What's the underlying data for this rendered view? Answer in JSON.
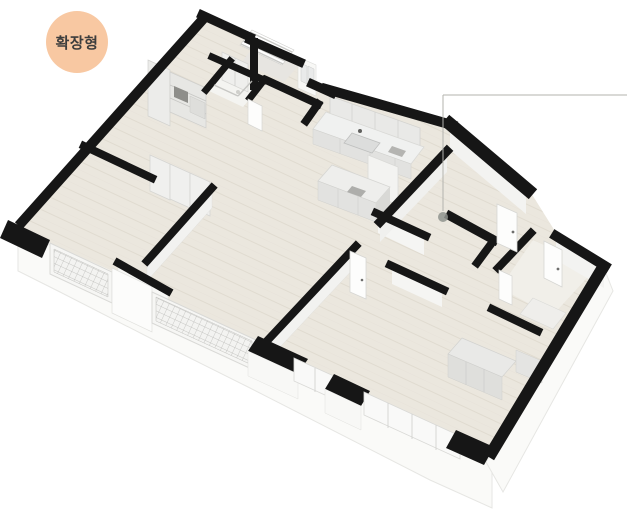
{
  "badge": {
    "label": "확장형",
    "bg": "#f8c8a2",
    "text_color": "#3d3d3d"
  },
  "palette": {
    "wall_black": "#161616",
    "floor_wood": "#ebe7de",
    "plank_line": "#e0dbd0",
    "frame_gray": "#d9d9d6",
    "callout_line": "#b3b3ae",
    "callout_dot": "#8f938e"
  },
  "floorplan": {
    "description": "3D isometric apartment floor plan, extended (확장형) layout",
    "shapes": [
      {
        "n": "exterior-wall-skirt-left",
        "t": "pg",
        "p": "18,228 52,246 112,274 152,293 258,342 298,360 336,380 366,396 458,439 492,456 492,508 430,480 250,388 150,338 60,292 18,271",
        "f": "#fafaf8",
        "s": "#e6e6e3",
        "w": 1
      },
      {
        "n": "exterior-wall-skirt-right",
        "t": "pg",
        "p": "604,268 613,291 503,492 486,462",
        "f": "#fafaf8",
        "s": "#e6e6e3",
        "w": 1
      },
      {
        "n": "left-wall-inner-face",
        "t": "pg",
        "p": "204,20 22,224 36,232 218,28",
        "f": "#ececea"
      },
      {
        "n": "floor-main",
        "t": "pg",
        "p": "206,14 300,58 314,84 332,92 450,124 528,190 533,196 558,236 604,266 492,452 458,436 364,393 334,380 294,360 256,341 150,293 112,271 52,244 16,226",
        "f": "url(#plank)"
      },
      {
        "n": "entry-floor",
        "t": "pg",
        "p": "254,46 298,66 284,82 242,62",
        "f": "#e7e5e1"
      },
      {
        "n": "bath1-floor",
        "t": "pg",
        "p": "230,62 266,79 243,107 207,90",
        "f": "#f4f4f1"
      },
      {
        "n": "bath2-floor",
        "t": "pg",
        "p": "533,240 596,268 552,316 500,288",
        "f": "#f1efe9"
      },
      {
        "n": "entry-stairs",
        "t": "pg",
        "p": "252,30 294,50 282,65 240,45",
        "f": "#ffffff",
        "s": "#cdcdca",
        "w": 0.6
      },
      {
        "n": "stair-step-1",
        "t": "l",
        "p": "250,32 292,52",
        "s": "#c8c8c5",
        "w": 1.4
      },
      {
        "n": "stair-step-2",
        "t": "l",
        "p": "248,35 290,55",
        "s": "#c8c8c5",
        "w": 1.4
      },
      {
        "n": "stair-step-3",
        "t": "l",
        "p": "246,37 288,57",
        "s": "#c8c8c5",
        "w": 1.4
      },
      {
        "n": "stair-step-4",
        "t": "l",
        "p": "245,39 287,59",
        "s": "#c8c8c5",
        "w": 1.4
      },
      {
        "n": "stair-step-5",
        "t": "l",
        "p": "243,41 285,61",
        "s": "#c8c8c5",
        "w": 1.4
      },
      {
        "n": "stair-step-6",
        "t": "l",
        "p": "241,44 283,64",
        "s": "#c8c8c5",
        "w": 1.4
      },
      {
        "n": "pantry-shelf-column",
        "t": "pg",
        "p": "148,60 170,70 170,126 148,116",
        "f": "#ececea",
        "s": "#d2d2cf",
        "w": 0.7
      },
      {
        "n": "pantry-shelf-unit",
        "t": "pg",
        "p": "170,72 206,88 206,128 170,112",
        "f": "#e7e7e4",
        "s": "#cfcfcc",
        "w": 0.7
      },
      {
        "n": "pantry-shelf-line-1",
        "t": "l",
        "p": "170,85 206,101",
        "s": "#c6c6c3",
        "w": 0.8
      },
      {
        "n": "pantry-shelf-line-2",
        "t": "l",
        "p": "170,98 206,114",
        "s": "#c6c6c3",
        "w": 0.8
      },
      {
        "n": "pantry-appliance",
        "t": "pg",
        "p": "174,86 188,92 188,103 174,97",
        "f": "#8e8e8a"
      },
      {
        "n": "pantry-box",
        "t": "pg",
        "p": "190,96 205,103 205,119 190,112",
        "f": "#dededb",
        "s": "#c9c9c6",
        "w": 0.5
      },
      {
        "n": "entry-closet",
        "t": "pg",
        "p": "222,52 248,64 248,92 222,80",
        "f": "#efefed",
        "s": "#d5d5d2",
        "w": 0.7
      },
      {
        "n": "entry-closet-line",
        "t": "l",
        "p": "235,58 235,86",
        "s": "#c9c9c6",
        "w": 0.7
      },
      {
        "n": "living-closet-column-1",
        "t": "pg",
        "p": "150,155 170,164 170,200 150,191",
        "f": "#f0f0ee",
        "s": "#d5d5d2",
        "w": 0.8
      },
      {
        "n": "living-closet-column-2",
        "t": "pg",
        "p": "170,164 190,173 190,208 170,199",
        "f": "#f0f0ee",
        "s": "#d5d5d2",
        "w": 0.8
      },
      {
        "n": "living-closet-column-3",
        "t": "pg",
        "p": "190,173 210,182 210,216 190,207",
        "f": "#f0f0ee",
        "s": "#d5d5d2",
        "w": 0.8
      },
      {
        "n": "kitchen-upper-cabinets",
        "t": "pg",
        "p": "330,96 420,128 420,146 330,114",
        "f": "#e9e9e7",
        "s": "#d3d3d0",
        "w": 0.8
      },
      {
        "n": "kitchen-cabinet-line-1",
        "t": "l",
        "p": "352,104 352,122",
        "s": "#d0d0cd",
        "w": 0.7
      },
      {
        "n": "kitchen-cabinet-line-2",
        "t": "l",
        "p": "375,112 375,130",
        "s": "#d0d0cd",
        "w": 0.7
      },
      {
        "n": "kitchen-cabinet-line-3",
        "t": "l",
        "p": "398,120 398,138",
        "s": "#d0d0cd",
        "w": 0.7
      },
      {
        "n": "kitchen-counter-top",
        "t": "pg",
        "p": "326,112 424,147 411,164 313,129",
        "f": "#f0f1f0",
        "s": "#d9d9d6",
        "w": 0.8
      },
      {
        "n": "kitchen-counter-front",
        "t": "pg",
        "p": "313,129 411,164 411,179 313,144",
        "f": "#e2e2e0",
        "s": "#d0d0cd",
        "w": 0.5
      },
      {
        "n": "kitchen-counter-front-line-1",
        "t": "l",
        "p": "340,139 340,154",
        "s": "#d0d0cd",
        "w": 0.6
      },
      {
        "n": "kitchen-counter-front-line-2",
        "t": "l",
        "p": "370,149 370,164",
        "s": "#d0d0cd",
        "w": 0.6
      },
      {
        "n": "kitchen-counter-front-line-3",
        "t": "l",
        "p": "395,158 395,173",
        "s": "#d0d0cd",
        "w": 0.6
      },
      {
        "n": "kitchen-sink",
        "t": "pg",
        "p": "352,133 380,143 372,153 344,143",
        "f": "#dcdddc",
        "s": "#bfc0bf",
        "w": 0.8
      },
      {
        "n": "kitchen-faucet",
        "t": "c",
        "p": "360,131,2",
        "f": "#5f5f5d"
      },
      {
        "n": "kitchen-hob",
        "t": "pg",
        "p": "392,146 406,151 402,157 388,152",
        "f": "#b4b4b1"
      },
      {
        "n": "kitchen-tall-cabinet",
        "t": "pg",
        "p": "368,155 398,167 398,205 368,193",
        "f": "#f3f3f1",
        "s": "#dadad7",
        "w": 0.8
      },
      {
        "n": "kitchen-island-top",
        "t": "pg",
        "p": "332,165 390,187 376,203 318,181",
        "f": "#eeeeec",
        "s": "#d6d6d3",
        "w": 0.8
      },
      {
        "n": "kitchen-island-front",
        "t": "pg",
        "p": "318,181 376,203 376,222 318,200",
        "f": "#e2e2e0",
        "s": "#d0d0cd",
        "w": 0.5
      },
      {
        "n": "kitchen-island-side",
        "t": "pg",
        "p": "376,203 390,187 390,206 376,222",
        "f": "#d9d9d6"
      },
      {
        "n": "kitchen-island-line-1",
        "t": "l",
        "p": "338,189 338,208",
        "s": "#d0d0cd",
        "w": 0.6
      },
      {
        "n": "kitchen-island-line-2",
        "t": "l",
        "p": "358,196 358,215",
        "s": "#d0d0cd",
        "w": 0.6
      },
      {
        "n": "kitchen-island-tray",
        "t": "pg",
        "p": "352,186 366,191 361,197 347,192",
        "f": "#aeaeab"
      },
      {
        "n": "wardrobe-top",
        "t": "pg",
        "p": "462,338 516,361 502,377 448,354",
        "f": "#e9e9e7",
        "s": "#d2d2cf",
        "w": 0.7
      },
      {
        "n": "wardrobe-front",
        "t": "pg",
        "p": "448,354 502,377 502,400 448,377",
        "f": "#dfdfdc",
        "s": "#cfcfcc",
        "w": 0.5
      },
      {
        "n": "wardrobe-front-line-1",
        "t": "l",
        "p": "466,362 466,385",
        "s": "#c9c9c6",
        "w": 0.6
      },
      {
        "n": "wardrobe-front-line-2",
        "t": "l",
        "p": "484,369 484,392",
        "s": "#c9c9c6",
        "w": 0.6
      },
      {
        "n": "wardrobe-side-column",
        "t": "pg",
        "p": "516,350 542,361 542,383 516,372",
        "f": "#e4e4e2",
        "s": "#d0d0cd",
        "w": 0.5
      },
      {
        "n": "bath2-vanity",
        "t": "pg",
        "p": "533,298 566,313 553,329 520,314",
        "f": "#efeeeb",
        "s": "#dadad7",
        "w": 0.6
      },
      {
        "n": "wall-face-master-divider",
        "t": "pg",
        "p": "212,188 147,261 147,281 212,208",
        "f": "#f2f2f0",
        "s": "#dcdcd9",
        "w": 0.4
      },
      {
        "n": "wall-face-bed2-divider",
        "t": "pg",
        "p": "356,246 266,342 266,362 356,266",
        "f": "#f2f2f0",
        "s": "#dcdcd9",
        "w": 0.4
      },
      {
        "n": "wall-face-bed3-a",
        "t": "pg",
        "p": "378,215 424,237 424,255 378,233",
        "f": "#f5f5f3"
      },
      {
        "n": "wall-face-bed3-b",
        "t": "pg",
        "p": "392,267 442,290 442,307 392,284",
        "f": "#f5f5f3"
      },
      {
        "n": "wall-face-kitchen-divider",
        "t": "pg",
        "p": "447,152 380,222 380,242 447,172",
        "f": "#f0f0ee"
      },
      {
        "n": "wall-face-hall-right",
        "t": "pg",
        "p": "450,130 526,194 526,214 450,150",
        "f": "#f3f3f1"
      },
      {
        "n": "wall-face-right-mid",
        "t": "pg",
        "p": "556,240 604,268 604,288 556,260",
        "f": "#f3f3f1"
      },
      {
        "n": "wall-face-balcony-divider",
        "t": "pg",
        "p": "118,266 168,294 168,316 118,288",
        "f": "#f7f7f5",
        "s": "#e2e2df",
        "w": 0.4
      },
      {
        "n": "entry-window-wall",
        "t": "pg",
        "p": "298,57 316,65 316,96 298,88",
        "f": "#f8f8f6",
        "s": "#dcdcd9",
        "w": 0.6
      },
      {
        "n": "entry-window-slot-1",
        "t": "pg",
        "p": "301,63 307,66 307,84 301,81",
        "f": "#e9eaea",
        "s": "#c9cac9",
        "w": 0.5
      },
      {
        "n": "entry-window-slot-2",
        "t": "pg",
        "p": "308,66 314,69 314,87 308,84",
        "f": "#e9eaea",
        "s": "#c9cac9",
        "w": 0.5
      },
      {
        "n": "balcony-railing-a-frame",
        "t": "pg",
        "p": "50,243 112,272 112,303 50,274",
        "f": "#f6f6f4",
        "s": "#d9d9d6",
        "w": 1
      },
      {
        "n": "balcony-railing-a-grid",
        "t": "pg",
        "p": "54,249 108,274 108,297 54,272",
        "f": "url(#grid)",
        "s": "#c2c2bf",
        "w": 0.5
      },
      {
        "n": "balcony-pier-white",
        "t": "pg",
        "p": "112,268 152,287 152,332 112,313",
        "f": "#fcfcfb",
        "s": "#e1e1de",
        "w": 0.7
      },
      {
        "n": "balcony-railing-b-frame",
        "t": "pg",
        "p": "152,292 256,340 256,371 152,323",
        "f": "#f6f6f4",
        "s": "#d9d9d6",
        "w": 1
      },
      {
        "n": "balcony-railing-b-grid",
        "t": "pg",
        "p": "156,297 252,341 252,365 156,321",
        "f": "url(#grid)",
        "s": "#c2c2bf",
        "w": 0.5
      },
      {
        "n": "wall-pier-black-1",
        "t": "pg",
        "p": "258,336 308,359 298,374 248,351",
        "f": "#161616"
      },
      {
        "n": "wall-pier-1-face",
        "t": "pg",
        "p": "248,351 298,374 298,399 248,376",
        "f": "#f8f8f6",
        "s": "#e2e2df",
        "w": 0.5
      },
      {
        "n": "window-bay-1",
        "t": "pg",
        "p": "294,358 336,377 336,400 294,381",
        "f": "#f9f9f8",
        "s": "#d9d9d6",
        "w": 0.8
      },
      {
        "n": "window-bay-1-mullion",
        "t": "l",
        "p": "315,368 315,392",
        "s": "#cfcfcc",
        "w": 0.8
      },
      {
        "n": "wall-pier-black-2",
        "t": "pg",
        "p": "334,374 370,391 361,406 325,389",
        "f": "#161616"
      },
      {
        "n": "wall-pier-2-face",
        "t": "pg",
        "p": "325,389 361,406 361,430 325,413",
        "f": "#f8f8f6",
        "s": "#e2e2df",
        "w": 0.5
      },
      {
        "n": "window-bay-2",
        "t": "pg",
        "p": "364,392 460,436 460,459 364,415",
        "f": "#f9f9f8",
        "s": "#d9d9d6",
        "w": 0.8
      },
      {
        "n": "window-bay-2-mullion-1",
        "t": "l",
        "p": "388,403 388,428",
        "s": "#cfcfcc",
        "w": 0.8
      },
      {
        "n": "window-bay-2-mullion-2",
        "t": "l",
        "p": "412,414 412,439",
        "s": "#cfcfcc",
        "w": 0.8
      },
      {
        "n": "window-bay-2-mullion-3",
        "t": "l",
        "p": "436,425 436,450",
        "s": "#cfcfcc",
        "w": 0.8
      },
      {
        "n": "wall-corner-black-bottom",
        "t": "pg",
        "p": "456,430 494,447 484,465 446,448",
        "f": "#161616"
      },
      {
        "n": "wall-outer-left",
        "t": "l",
        "p": "204,18 22,222",
        "s": "#161616",
        "w": 10
      },
      {
        "n": "wall-corner-block-left",
        "t": "pg",
        "p": "8,220 50,240 42,258 0,238",
        "f": "#161616"
      },
      {
        "n": "wall-apex",
        "t": "l",
        "p": "202,15 250,37",
        "s": "#161616",
        "w": 9
      },
      {
        "n": "wall-entry-top",
        "t": "l",
        "p": "250,40 300,62",
        "s": "#161616",
        "w": 9
      },
      {
        "n": "wall-entry-stem",
        "t": "l",
        "p": "254,42 254,86",
        "s": "#161616",
        "w": 8
      },
      {
        "n": "wall-entry-jog",
        "t": "l",
        "p": "312,84 332,93",
        "s": "#161616",
        "w": 9
      },
      {
        "n": "wall-kitchen-top",
        "t": "l",
        "p": "326,89 452,125",
        "s": "#161616",
        "w": 10
      },
      {
        "n": "wall-right-upper",
        "t": "l",
        "p": "450,124 528,190",
        "s": "#161616",
        "w": 13
      },
      {
        "n": "wall-right-mid",
        "t": "l",
        "p": "556,236 605,266",
        "s": "#161616",
        "w": 10
      },
      {
        "n": "wall-right-bottom",
        "t": "l",
        "p": "602,269 492,452",
        "s": "#161616",
        "w": 12
      },
      {
        "n": "wall-master-top",
        "t": "l",
        "p": "84,146 152,178",
        "s": "#161616",
        "w": 8
      },
      {
        "n": "wall-master-divider",
        "t": "l",
        "p": "212,188 147,261",
        "s": "#161616",
        "w": 8
      },
      {
        "n": "wall-bed2-divider",
        "t": "l",
        "p": "356,246 266,342",
        "s": "#161616",
        "w": 8
      },
      {
        "n": "wall-bed3-top-a",
        "t": "l",
        "p": "376,213 426,236",
        "s": "#161616",
        "w": 8
      },
      {
        "n": "wall-bed3-top-b",
        "t": "l",
        "p": "390,265 444,290",
        "s": "#161616",
        "w": 8
      },
      {
        "n": "wall-bath1-top",
        "t": "l",
        "p": "212,57 264,80",
        "s": "#161616",
        "w": 7
      },
      {
        "n": "wall-bath1-left",
        "t": "l",
        "p": "206,90 230,61",
        "s": "#161616",
        "w": 7
      },
      {
        "n": "wall-bath1-right",
        "t": "l",
        "p": "264,80 250,98",
        "s": "#161616",
        "w": 7
      },
      {
        "n": "wall-bath1-kitchen",
        "t": "l",
        "p": "266,80 318,104",
        "s": "#161616",
        "w": 8
      },
      {
        "n": "wall-bath1-kitchen-stub",
        "t": "l",
        "p": "318,104 306,121",
        "s": "#161616",
        "w": 8
      },
      {
        "n": "wall-bath2-left",
        "t": "l",
        "p": "531,233 498,268",
        "s": "#161616",
        "w": 8
      },
      {
        "n": "wall-bath2-lower",
        "t": "l",
        "p": "492,309 538,331",
        "s": "#161616",
        "w": 8
      },
      {
        "n": "wall-kitchen-divider",
        "t": "l",
        "p": "447,151 380,222",
        "s": "#161616",
        "w": 9
      },
      {
        "n": "wall-hall-c",
        "t": "l",
        "p": "450,216 494,240",
        "s": "#161616",
        "w": 9
      },
      {
        "n": "wall-hall-d",
        "t": "l",
        "p": "494,240 477,263",
        "s": "#161616",
        "w": 8
      },
      {
        "n": "wall-balcony-divider",
        "t": "l",
        "p": "118,263 168,291",
        "s": "#161616",
        "w": 8
      },
      {
        "n": "bath1-drain",
        "t": "c",
        "p": "238,92,2",
        "f": "#cfcfcb"
      },
      {
        "n": "bath1-glass-partition-1",
        "t": "l",
        "p": "214,85 238,96",
        "s": "#c2c2bf",
        "w": 1.4,
        "o": 0.9
      },
      {
        "n": "bath1-glass-partition-2",
        "t": "l",
        "p": "238,96 252,81",
        "s": "#c2c2bf",
        "w": 1.4,
        "o": 0.9
      },
      {
        "n": "door-hall-1",
        "t": "pg",
        "p": "497,204 517,213 517,252 497,243",
        "f": "#fdfdfc",
        "s": "#d6d6d3",
        "w": 0.8
      },
      {
        "n": "door-hall-1-handle",
        "t": "c",
        "p": "513,232,1.4",
        "f": "#6e6e6c"
      },
      {
        "n": "door-hall-2",
        "t": "pg",
        "p": "544,241 562,250 562,287 544,278",
        "f": "#fdfdfc",
        "s": "#d6d6d3",
        "w": 0.8
      },
      {
        "n": "door-hall-2-handle",
        "t": "c",
        "p": "558,269,1.4",
        "f": "#6e6e6c"
      },
      {
        "n": "door-bed2",
        "t": "pg",
        "p": "350,251 366,258 366,299 350,292",
        "f": "#fdfdfc",
        "s": "#d6d6d3",
        "w": 0.8
      },
      {
        "n": "door-bed2-handle",
        "t": "c",
        "p": "362,280,1.3",
        "f": "#6e6e6c"
      },
      {
        "n": "door-bath1",
        "t": "pg",
        "p": "248,99 262,106 262,131 248,124",
        "f": "#fdfdfc",
        "s": "#d6d6d3",
        "w": 0.7
      },
      {
        "n": "door-bath2",
        "t": "pg",
        "p": "499,270 512,276 512,305 499,299",
        "f": "#fdfdfc",
        "s": "#d6d6d3",
        "w": 0.7
      },
      {
        "n": "callout-line-vertical",
        "t": "l",
        "p": "443,95 443,211",
        "s": "#b3b3ae",
        "w": 1
      },
      {
        "n": "callout-line-horizontal",
        "t": "l",
        "p": "443,95 627,95",
        "s": "#b3b3ae",
        "w": 1
      },
      {
        "n": "callout-dot",
        "t": "c",
        "p": "443,217,5",
        "f": "#8f938e",
        "o": 0.85
      }
    ]
  }
}
